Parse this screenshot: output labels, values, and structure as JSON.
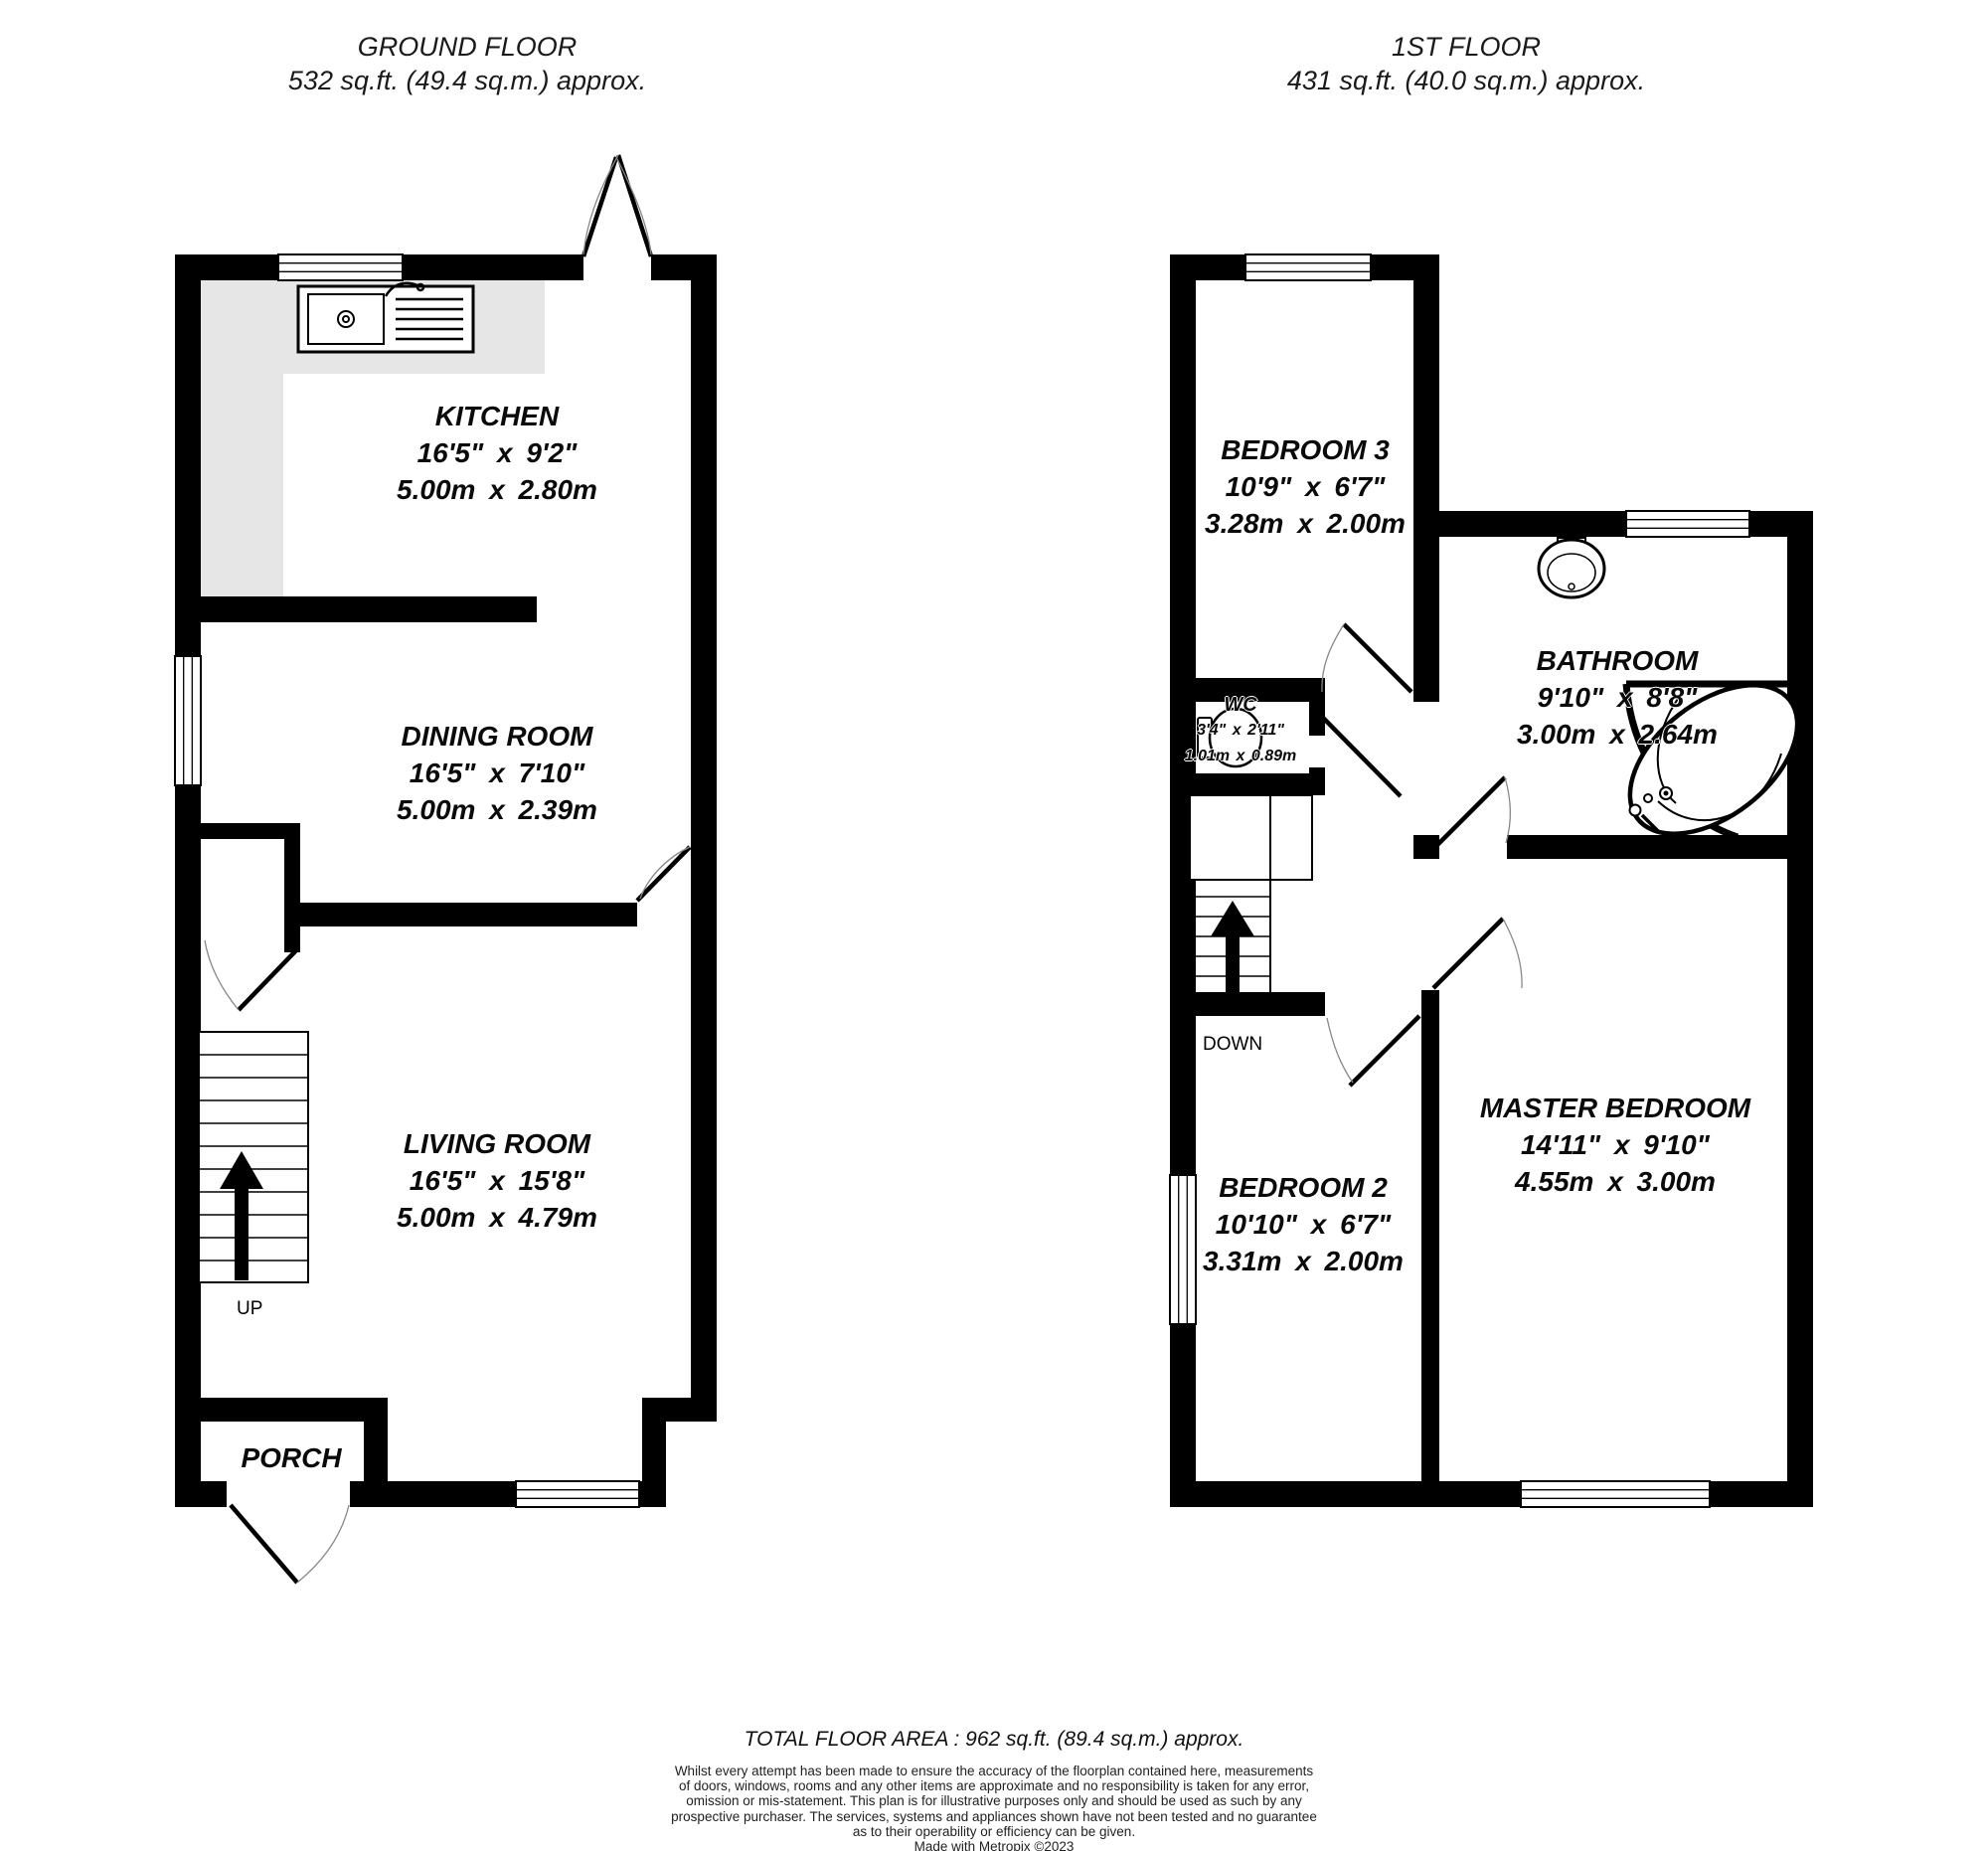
{
  "ground_floor": {
    "title": "GROUND FLOOR",
    "area": "532 sq.ft. (49.4 sq.m.) approx."
  },
  "first_floor": {
    "title": "1ST FLOOR",
    "area": "431 sq.ft. (40.0 sq.m.) approx."
  },
  "rooms": {
    "kitchen": {
      "name": "KITCHEN",
      "imperial": "16'5\" x 9'2\"",
      "metric": "5.00m x 2.80m"
    },
    "dining_room": {
      "name": "DINING ROOM",
      "imperial": "16'5\" x 7'10\"",
      "metric": "5.00m x 2.39m"
    },
    "living_room": {
      "name": "LIVING ROOM",
      "imperial": "16'5\" x 15'8\"",
      "metric": "5.00m x 4.79m"
    },
    "porch": {
      "name": "PORCH"
    },
    "bedroom3": {
      "name": "BEDROOM 3",
      "imperial": "10'9\" x 6'7\"",
      "metric": "3.28m x 2.00m"
    },
    "bathroom": {
      "name": "BATHROOM",
      "imperial": "9'10\" x 8'8\"",
      "metric": "3.00m x 2.64m"
    },
    "wc": {
      "name": "WC",
      "imperial": "3'4\" x 2'11\"",
      "metric": "1.01m x 0.89m"
    },
    "master_bedroom": {
      "name": "MASTER BEDROOM",
      "imperial": "14'11\" x 9'10\"",
      "metric": "4.55m x 3.00m"
    },
    "bedroom2": {
      "name": "BEDROOM 2",
      "imperial": "10'10\" x 6'7\"",
      "metric": "3.31m x 2.00m"
    }
  },
  "stairs": {
    "up_label": "UP",
    "down_label": "DOWN"
  },
  "footer": {
    "total_area": "TOTAL FLOOR AREA : 962 sq.ft. (89.4 sq.m.) approx.",
    "disclaimer_lines": [
      "Whilst every attempt has been made to ensure the accuracy of the floorplan contained here, measurements",
      "of doors, windows, rooms and any other items are approximate and no responsibility is taken for any error,",
      "omission or mis-statement. This plan is for illustrative purposes only and should be used as such by any",
      "prospective purchaser. The services, systems and appliances shown have not been tested and no guarantee",
      "as to their operability or efficiency can be given."
    ],
    "credit": "Made with Metropix ©2023"
  },
  "colors": {
    "wall": "#000000",
    "counter": "#e6e6e6",
    "room_fill": "#ffffff",
    "door_arc": "#888888",
    "text": "#000000"
  }
}
